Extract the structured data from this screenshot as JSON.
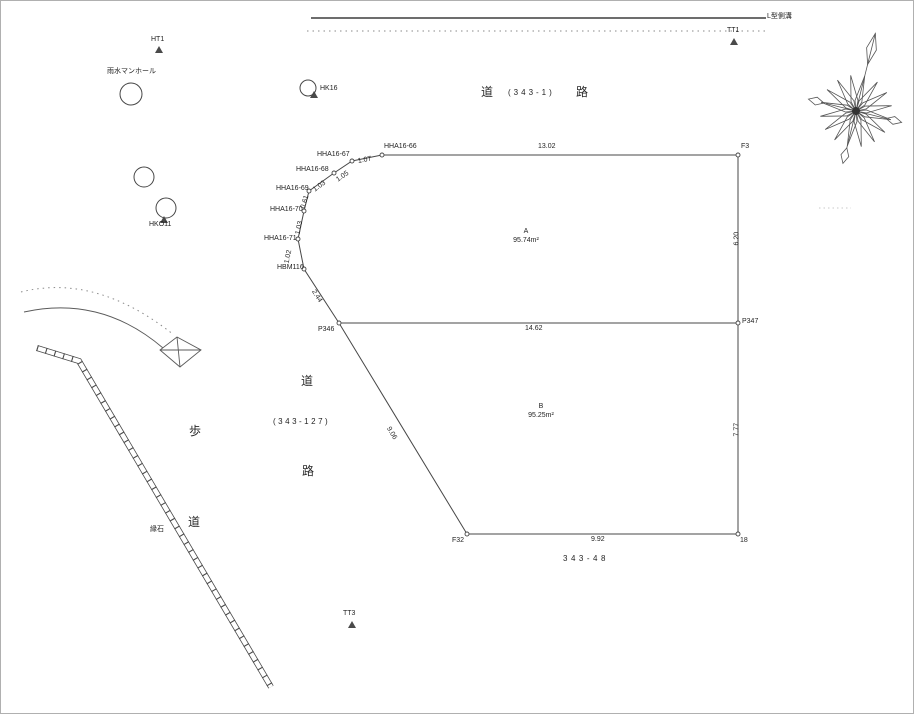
{
  "colors": {
    "line": "#474747",
    "text": "#1f1f1f"
  },
  "top_strip": {
    "gutter_label": "L型側溝"
  },
  "road_main": {
    "k1": "道",
    "num": "(343-1)",
    "k2": "路"
  },
  "side_road": {
    "k1": "道",
    "num": "(343-127)",
    "k2": "路"
  },
  "sidewalk": {
    "ho": "歩",
    "do": "道",
    "curb": "縁石"
  },
  "landmarks": {
    "ht1": "HT1",
    "tt1": "TT1",
    "tt3": "TT3",
    "manhole": "雨水マンホール",
    "hk16": "HK16",
    "hko11": "HKO11"
  },
  "points": {
    "hha66": "HHA16-66",
    "hha67": "HHA16-67",
    "hha68": "HHA16-68",
    "hha69": "HHA16-69",
    "hha70": "HHA16-70",
    "hha71": "HHA16-71",
    "hbm116": "HBM116",
    "p346": "P346",
    "p347": "P347",
    "f3": "F3",
    "f32": "F32",
    "pt18": "18"
  },
  "segment_lengths": {
    "s66_67": "1.07",
    "s67_68": "1.05",
    "s68_69": "1.03",
    "s69_70": "0.61",
    "s70_71": "1.03",
    "s71_hbm": "1.02",
    "hbm_p346": "2.44"
  },
  "dimensions": {
    "top": "13.02",
    "right_a": "6.20",
    "middle": "14.62",
    "right_b": "7.77",
    "bottom": "9.92",
    "left_b": "9.06"
  },
  "parcels": {
    "a_name": "A",
    "a_area": "95.74m²",
    "b_name": "B",
    "b_area": "95.25m²"
  },
  "lot_number": "343-48"
}
